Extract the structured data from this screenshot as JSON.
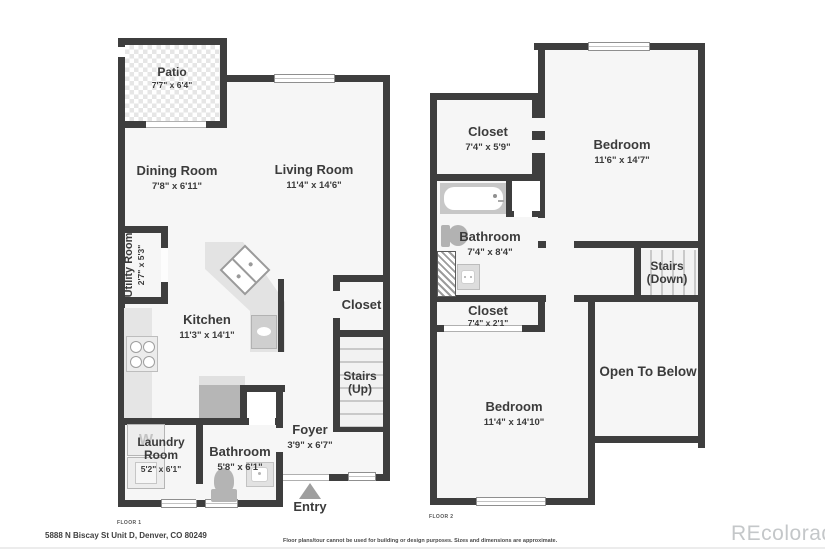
{
  "footer": {
    "address": "5888 N Biscay St Unit D, Denver, CO 80249",
    "disclaimer": "Floor plans/tour cannot be used for building or design purposes. Sizes and dimensions are approximate.",
    "watermark": "REcolorado"
  },
  "colors": {
    "wall": "#3e3e3e",
    "room_fill": "#f6f6f6",
    "fixture_gray": "#b6b6b6"
  },
  "floor1": {
    "tag": "FLOOR 1",
    "entry_label": "Entry",
    "washer_letter": "W",
    "rooms": {
      "patio": {
        "name": "Patio",
        "dims": "7'7\" x 6'4\""
      },
      "dining": {
        "name": "Dining Room",
        "dims": "7'8\" x 6'11\""
      },
      "living": {
        "name": "Living Room",
        "dims": "11'4\" x 14'6\""
      },
      "utility": {
        "name": "Utility Room",
        "dims": "2'7\" x 5'3\""
      },
      "kitchen": {
        "name": "Kitchen",
        "dims": "11'3\" x 14'1\""
      },
      "closet": {
        "name": "Closet"
      },
      "stairs": {
        "name": "Stairs",
        "sub": "(Up)"
      },
      "laundry": {
        "name": "Laundry Room",
        "dims": "5'2\" x 6'1\""
      },
      "bathroom": {
        "name": "Bathroom",
        "dims": "5'8\" x 6'1\""
      },
      "foyer": {
        "name": "Foyer",
        "dims": "3'9\" x 6'7\""
      }
    }
  },
  "floor2": {
    "tag": "FLOOR 2",
    "rooms": {
      "closet_top": {
        "name": "Closet",
        "dims": "7'4\" x 5'9\""
      },
      "bedroom_top": {
        "name": "Bedroom",
        "dims": "11'6\" x 14'7\""
      },
      "bathroom": {
        "name": "Bathroom",
        "dims": "7'4\" x 8'4\""
      },
      "stairs": {
        "name": "Stairs",
        "sub": "(Down)"
      },
      "closet_mid": {
        "name": "Closet",
        "dims": "7'4\" x 2'1\""
      },
      "bedroom_bottom": {
        "name": "Bedroom",
        "dims": "11'4\" x 14'10\""
      },
      "open_to_below": {
        "name": "Open To Below"
      }
    }
  }
}
